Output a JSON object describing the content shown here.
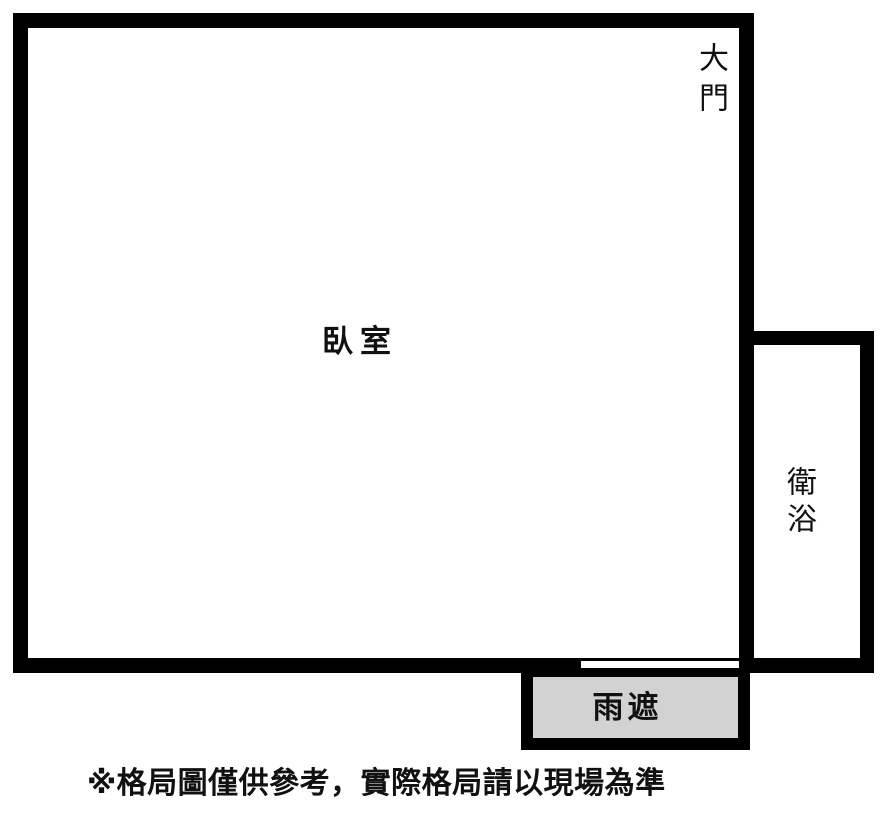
{
  "canvas": {
    "width_px": 889,
    "height_px": 820,
    "background": "#ffffff"
  },
  "colors": {
    "wall": "#000000",
    "awning_fill": "#d2d2d2",
    "text": "#111111"
  },
  "floor_plan": {
    "rooms": {
      "bedroom": {
        "label": "臥室"
      },
      "bathroom": {
        "label": "衛浴"
      }
    },
    "features": {
      "main_door": {
        "label": "大門"
      },
      "awning": {
        "label": "雨遮"
      },
      "window": {
        "type": "sliding-window-symbol"
      }
    },
    "disclaimer": "※格局圖僅供參考，實際格局請以現場為準"
  }
}
